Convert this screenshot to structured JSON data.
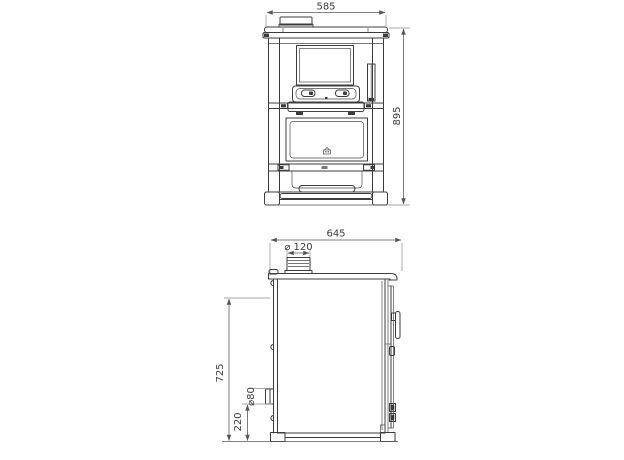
{
  "front_view": {
    "width": "585",
    "height": "895"
  },
  "side_view": {
    "depth": "645",
    "flue_diameter": "⌀ 120",
    "flue_center_height": "725",
    "rear_outlet_height": "220",
    "rear_outlet_diameter": "⌀80"
  }
}
